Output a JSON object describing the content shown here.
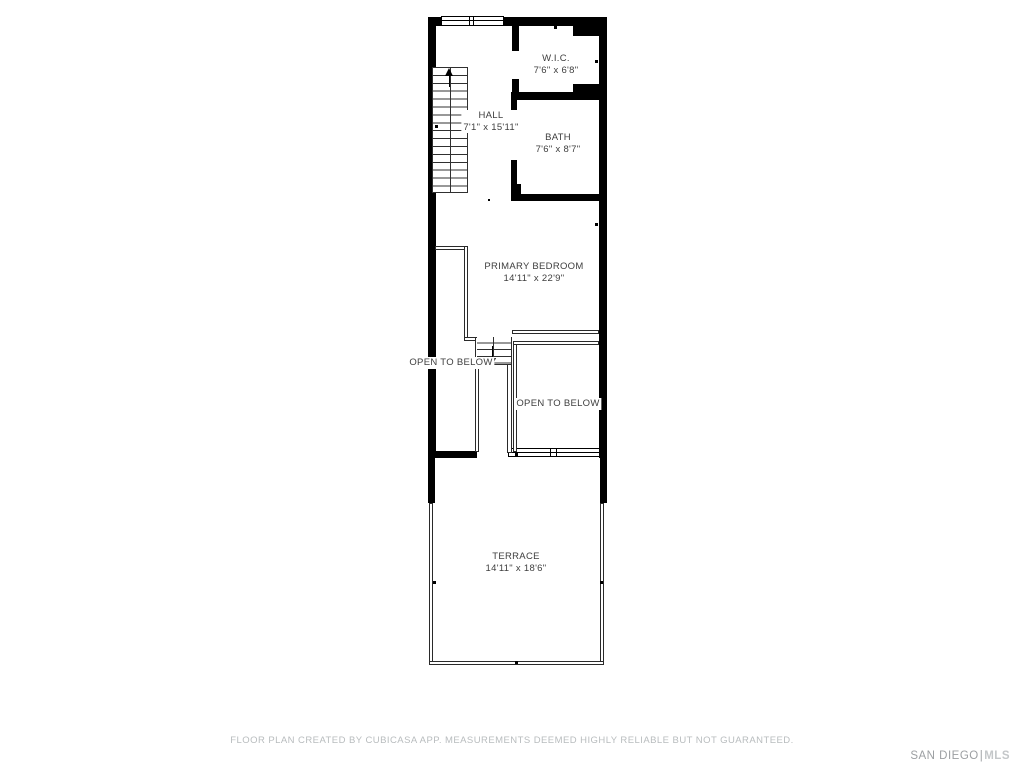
{
  "plan": {
    "rooms": [
      {
        "name": "W.I.C.",
        "dims": "7'6\" x 6'8\""
      },
      {
        "name": "HALL",
        "dims": "7'1\" x 15'11\""
      },
      {
        "name": "BATH",
        "dims": "7'6\" x 8'7\""
      },
      {
        "name": "PRIMARY BEDROOM",
        "dims": "14'11\" x 22'9\""
      },
      {
        "name": "TERRACE",
        "dims": "14'11\" x 18'6\""
      }
    ],
    "open_to_below_left": "OPEN TO BELOW",
    "open_to_below_right": "OPEN TO BELOW"
  },
  "footer": {
    "disclaimer": "FLOOR PLAN CREATED BY CUBICASA APP. MEASUREMENTS DEEMED HIGHLY RELIABLE BUT NOT GUARANTEED."
  },
  "logo": {
    "primary": "SAN DIEGO",
    "separator": "|",
    "secondary": "MLS"
  },
  "colors": {
    "walls": "#000000",
    "room_label": "#3e3e3e",
    "disclaimer_text": "#b8bcbe",
    "logo_primary": "#9c9fa2",
    "logo_secondary": "#c4c7c9",
    "background": "#ffffff"
  }
}
